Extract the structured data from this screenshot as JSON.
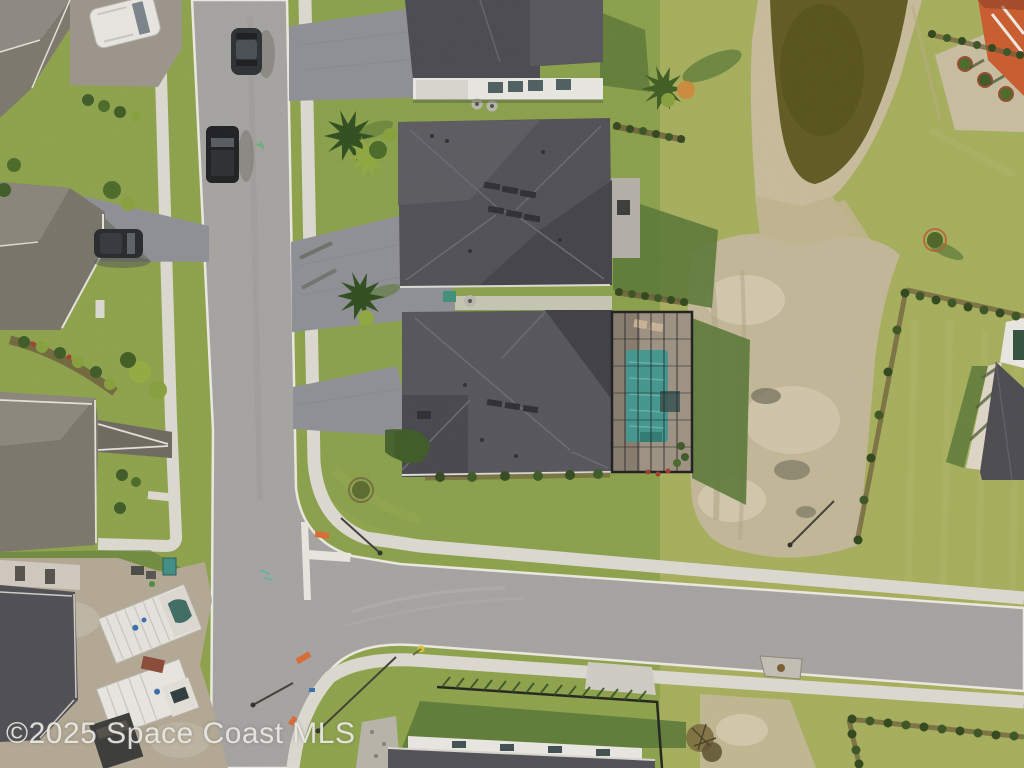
{
  "image_type": "aerial-drone-photo",
  "watermark": {
    "text": "©2025 Space Coast MLS"
  },
  "scene": {
    "setting": "Aerial drone view of a Florida suburban neighborhood: T-intersection, new homes, screened pool enclosure, retention pond, construction lot",
    "landmarks": [
      "retention-pond",
      "screened-pool-home",
      "large-hip-roof-home",
      "top-edge-home",
      "left-row-homes",
      "construction-lot",
      "t-intersection",
      "dirt-patch",
      "hedge-rows",
      "black-fence",
      "bottom-edge-home",
      "white-lanai-home",
      "orange-roof-building"
    ],
    "vehicles": [
      "white-van",
      "dark-car-on-road",
      "black-truck-parked",
      "suv-in-driveway",
      "box-trailer-1",
      "box-trailer-2",
      "white-truck-cab",
      "dark-trailer"
    ],
    "colors": {
      "grass": "#8da24b",
      "grass_light": "#a6ae5c",
      "grass_shadow": "#5a7836",
      "road": "#a5a3a1",
      "sidewalk": "#dcd9d0",
      "curb": "#ece9e1",
      "roof_dark": "#4f4e55",
      "roof_gray": "#7c776d",
      "paver": "#8e8f95",
      "pool": "#42968e",
      "pool_deck": "#9d9182",
      "pond": "#5f5a21",
      "sand": "#c7bb9b",
      "dirt": "#c2b697",
      "white_wall": "#e9e7e2",
      "orange_roof": "#c95b2d",
      "hedge": "#31461d",
      "fence": "#23231e",
      "marking_white": "#e8e6df",
      "marking_orange": "#d96a33"
    }
  }
}
